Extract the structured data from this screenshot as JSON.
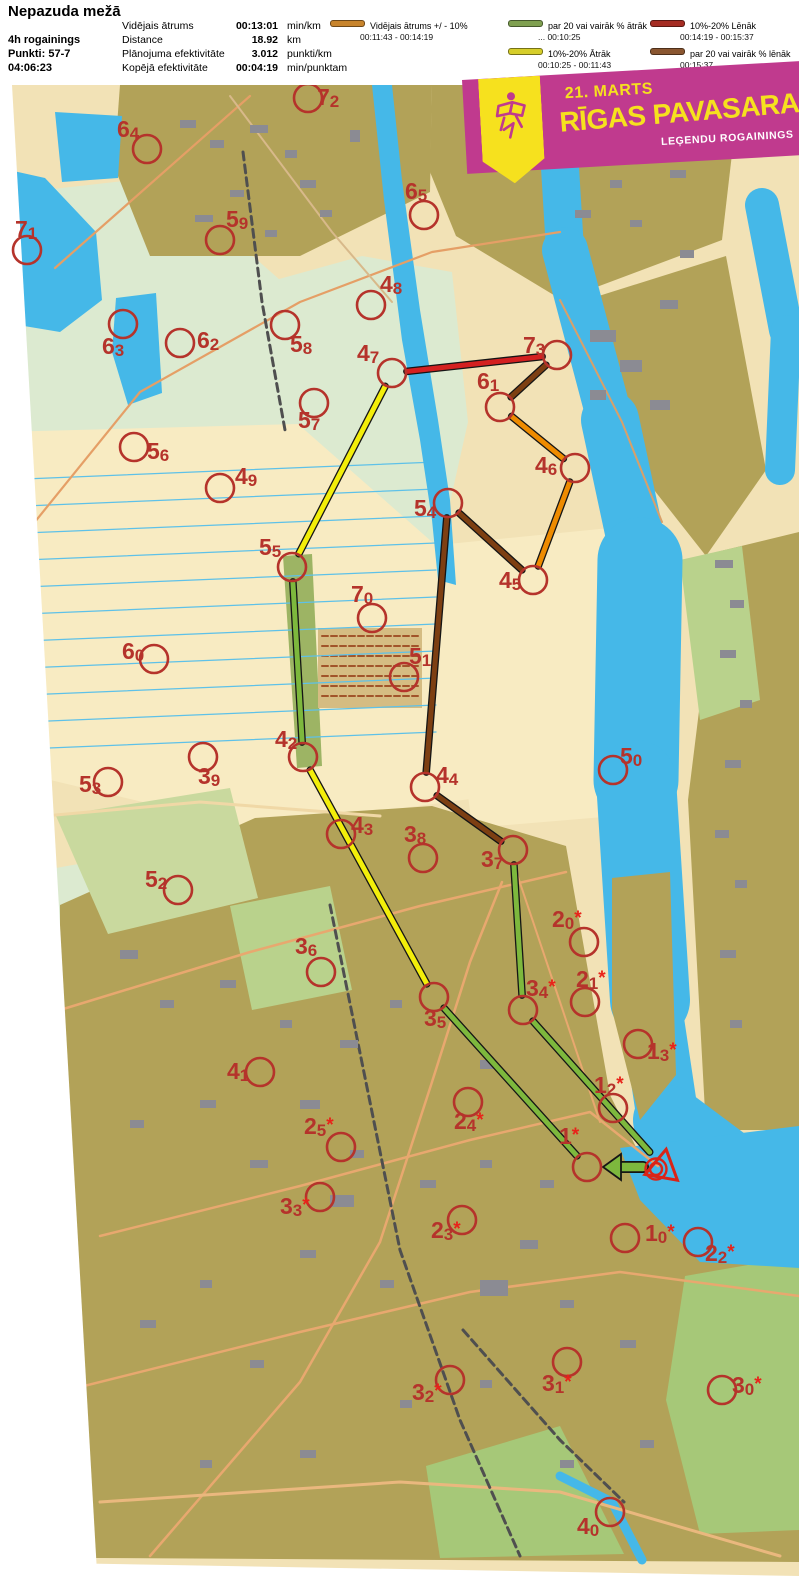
{
  "header": {
    "title": "Nepazuda mežā",
    "event_info": [
      "4h rogainings",
      "Punkti: 57-7",
      "04:06:23"
    ],
    "stats": [
      {
        "label": "Vidējais ātrums",
        "value": "00:13:01",
        "unit": "min/km"
      },
      {
        "label": "Distance",
        "value": "18.92",
        "unit": "km"
      },
      {
        "label": "Plānojuma efektivitāte",
        "value": "3.012",
        "unit": "punkti/km"
      },
      {
        "label": "Kopējā efektivitāte",
        "value": "00:04:19",
        "unit": "min/punktam"
      }
    ],
    "legend": {
      "columns": [
        [
          {
            "label": "Vidējais ātrums +/ - 10%",
            "range": "00:11:43   -   00:14:19",
            "color": "#c8842c"
          }
        ],
        [
          {
            "label": "par 20 vai vairāk % ātrāk",
            "range": "...   00:10:25",
            "color": "#7fa050"
          },
          {
            "label": "10%-20% Ātrāk",
            "range": "00:10:25   -   00:11:43",
            "color": "#d6ce2a"
          }
        ],
        [
          {
            "label": "10%-20% Lēnāk",
            "range": "00:14:19   -   00:15:37",
            "color": "#a52c22"
          },
          {
            "label": "par 20 vai vairāk % lēnāk",
            "range": "00:15:37   ...",
            "color": "#8a5630"
          }
        ]
      ]
    }
  },
  "banner": {
    "date": "21. MARTS",
    "title": "RĪGAS PAVASARA",
    "subtitle": "LEĢENDU ROGAININGS",
    "bg": "#c03a8e",
    "accent": "#f6e11e"
  },
  "map": {
    "colors": {
      "control": "#b5332b",
      "star": "#e8231a",
      "start": "#da2418",
      "water": "#45b8e8"
    },
    "route_colors": {
      "green": "#7db83d",
      "yellow": "#f3ee0a",
      "red": "#d42020",
      "orange": "#ee8b00",
      "brown": "#7d3f12"
    },
    "start_finish": {
      "x": 663,
      "y": 1167
    },
    "route": [
      {
        "from": "start",
        "to": "1",
        "color": "green",
        "arrow": true
      },
      {
        "from": "1",
        "to": "35",
        "color": "green"
      },
      {
        "from": "35",
        "to": "42",
        "color": "yellow"
      },
      {
        "from": "42",
        "to": "55",
        "color": "green"
      },
      {
        "from": "55",
        "to": "47",
        "color": "yellow"
      },
      {
        "from": "47",
        "to": "73",
        "color": "red"
      },
      {
        "from": "73",
        "to": "61",
        "color": "brown"
      },
      {
        "from": "61",
        "to": "46",
        "color": "orange"
      },
      {
        "from": "46",
        "to": "45",
        "color": "orange"
      },
      {
        "from": "45",
        "to": "54",
        "color": "brown"
      },
      {
        "from": "54",
        "to": "44",
        "color": "brown"
      },
      {
        "from": "44",
        "to": "37",
        "color": "brown"
      },
      {
        "from": "37",
        "to": "34",
        "color": "green"
      },
      {
        "from": "34",
        "to": "start",
        "color": "green"
      }
    ],
    "controls": [
      {
        "id": "72",
        "cx": 308,
        "cy": 98,
        "lx": 317,
        "ly": 105
      },
      {
        "id": "64",
        "cx": 147,
        "cy": 149,
        "lx": 117,
        "ly": 137
      },
      {
        "id": "65",
        "cx": 424,
        "cy": 215,
        "lx": 405,
        "ly": 199
      },
      {
        "id": "71",
        "cx": 27,
        "cy": 250,
        "lx": 15,
        "ly": 237
      },
      {
        "id": "59",
        "cx": 220,
        "cy": 240,
        "lx": 226,
        "ly": 227
      },
      {
        "id": "48",
        "cx": 371,
        "cy": 305,
        "lx": 380,
        "ly": 292
      },
      {
        "id": "63",
        "cx": 123,
        "cy": 324,
        "lx": 102,
        "ly": 354
      },
      {
        "id": "62",
        "cx": 180,
        "cy": 343,
        "lx": 197,
        "ly": 348
      },
      {
        "id": "58",
        "cx": 285,
        "cy": 325,
        "lx": 290,
        "ly": 352
      },
      {
        "id": "47",
        "cx": 392,
        "cy": 373,
        "lx": 357,
        "ly": 361
      },
      {
        "id": "73",
        "cx": 557,
        "cy": 355,
        "lx": 523,
        "ly": 353
      },
      {
        "id": "61",
        "cx": 500,
        "cy": 407,
        "lx": 477,
        "ly": 389
      },
      {
        "id": "57",
        "cx": 314,
        "cy": 403,
        "lx": 298,
        "ly": 428
      },
      {
        "id": "56",
        "cx": 134,
        "cy": 447,
        "lx": 147,
        "ly": 459
      },
      {
        "id": "46",
        "cx": 575,
        "cy": 468,
        "lx": 535,
        "ly": 473
      },
      {
        "id": "49",
        "cx": 220,
        "cy": 488,
        "lx": 235,
        "ly": 484
      },
      {
        "id": "54",
        "cx": 448,
        "cy": 503,
        "lx": 414,
        "ly": 516
      },
      {
        "id": "55",
        "cx": 292,
        "cy": 567,
        "lx": 259,
        "ly": 555
      },
      {
        "id": "45",
        "cx": 533,
        "cy": 580,
        "lx": 499,
        "ly": 588
      },
      {
        "id": "70",
        "cx": 372,
        "cy": 618,
        "lx": 351,
        "ly": 602
      },
      {
        "id": "60",
        "cx": 154,
        "cy": 659,
        "lx": 122,
        "ly": 659
      },
      {
        "id": "51",
        "cx": 404,
        "cy": 677,
        "lx": 409,
        "ly": 664
      },
      {
        "id": "50",
        "cx": 613,
        "cy": 770,
        "lx": 620,
        "ly": 764
      },
      {
        "id": "42",
        "cx": 303,
        "cy": 757,
        "lx": 275,
        "ly": 747
      },
      {
        "id": "39",
        "cx": 203,
        "cy": 757,
        "lx": 198,
        "ly": 784
      },
      {
        "id": "53",
        "cx": 108,
        "cy": 782,
        "lx": 79,
        "ly": 792
      },
      {
        "id": "44",
        "cx": 425,
        "cy": 787,
        "lx": 436,
        "ly": 783
      },
      {
        "id": "43",
        "cx": 341,
        "cy": 834,
        "lx": 351,
        "ly": 833
      },
      {
        "id": "38",
        "cx": 423,
        "cy": 858,
        "lx": 404,
        "ly": 842
      },
      {
        "id": "37",
        "cx": 513,
        "cy": 850,
        "lx": 481,
        "ly": 867
      },
      {
        "id": "52",
        "cx": 178,
        "cy": 890,
        "lx": 145,
        "ly": 887
      },
      {
        "id": "20",
        "star": true,
        "cx": 584,
        "cy": 942,
        "lx": 552,
        "ly": 927
      },
      {
        "id": "36",
        "cx": 321,
        "cy": 972,
        "lx": 295,
        "ly": 954
      },
      {
        "id": "34",
        "star": true,
        "cx": 523,
        "cy": 1010,
        "lx": 526,
        "ly": 996
      },
      {
        "id": "21",
        "star": true,
        "cx": 585,
        "cy": 1002,
        "lx": 576,
        "ly": 987
      },
      {
        "id": "35",
        "cx": 434,
        "cy": 997,
        "lx": 424,
        "ly": 1026
      },
      {
        "id": "13",
        "star": true,
        "cx": 638,
        "cy": 1044,
        "lx": 647,
        "ly": 1059
      },
      {
        "id": "41",
        "cx": 260,
        "cy": 1072,
        "lx": 227,
        "ly": 1079
      },
      {
        "id": "12",
        "star": true,
        "cx": 613,
        "cy": 1108,
        "lx": 594,
        "ly": 1093
      },
      {
        "id": "25",
        "star": true,
        "cx": 341,
        "cy": 1147,
        "lx": 304,
        "ly": 1134
      },
      {
        "id": "24",
        "star": true,
        "cx": 468,
        "cy": 1102,
        "lx": 454,
        "ly": 1129
      },
      {
        "id": "1",
        "star": true,
        "cx": 587,
        "cy": 1167,
        "lx": 559,
        "ly": 1144
      },
      {
        "id": "33",
        "star": true,
        "cx": 320,
        "cy": 1197,
        "lx": 280,
        "ly": 1214
      },
      {
        "id": "23",
        "star": true,
        "cx": 462,
        "cy": 1220,
        "lx": 431,
        "ly": 1238
      },
      {
        "id": "10",
        "star": true,
        "cx": 625,
        "cy": 1238,
        "lx": 645,
        "ly": 1241
      },
      {
        "id": "22",
        "star": true,
        "cx": 698,
        "cy": 1242,
        "lx": 705,
        "ly": 1261
      },
      {
        "id": "31",
        "star": true,
        "cx": 567,
        "cy": 1362,
        "lx": 542,
        "ly": 1391
      },
      {
        "id": "32",
        "star": true,
        "cx": 450,
        "cy": 1380,
        "lx": 412,
        "ly": 1400
      },
      {
        "id": "30",
        "star": true,
        "cx": 722,
        "cy": 1390,
        "lx": 732,
        "ly": 1393
      },
      {
        "id": "40",
        "cx": 610,
        "cy": 1512,
        "lx": 577,
        "ly": 1534
      }
    ]
  }
}
